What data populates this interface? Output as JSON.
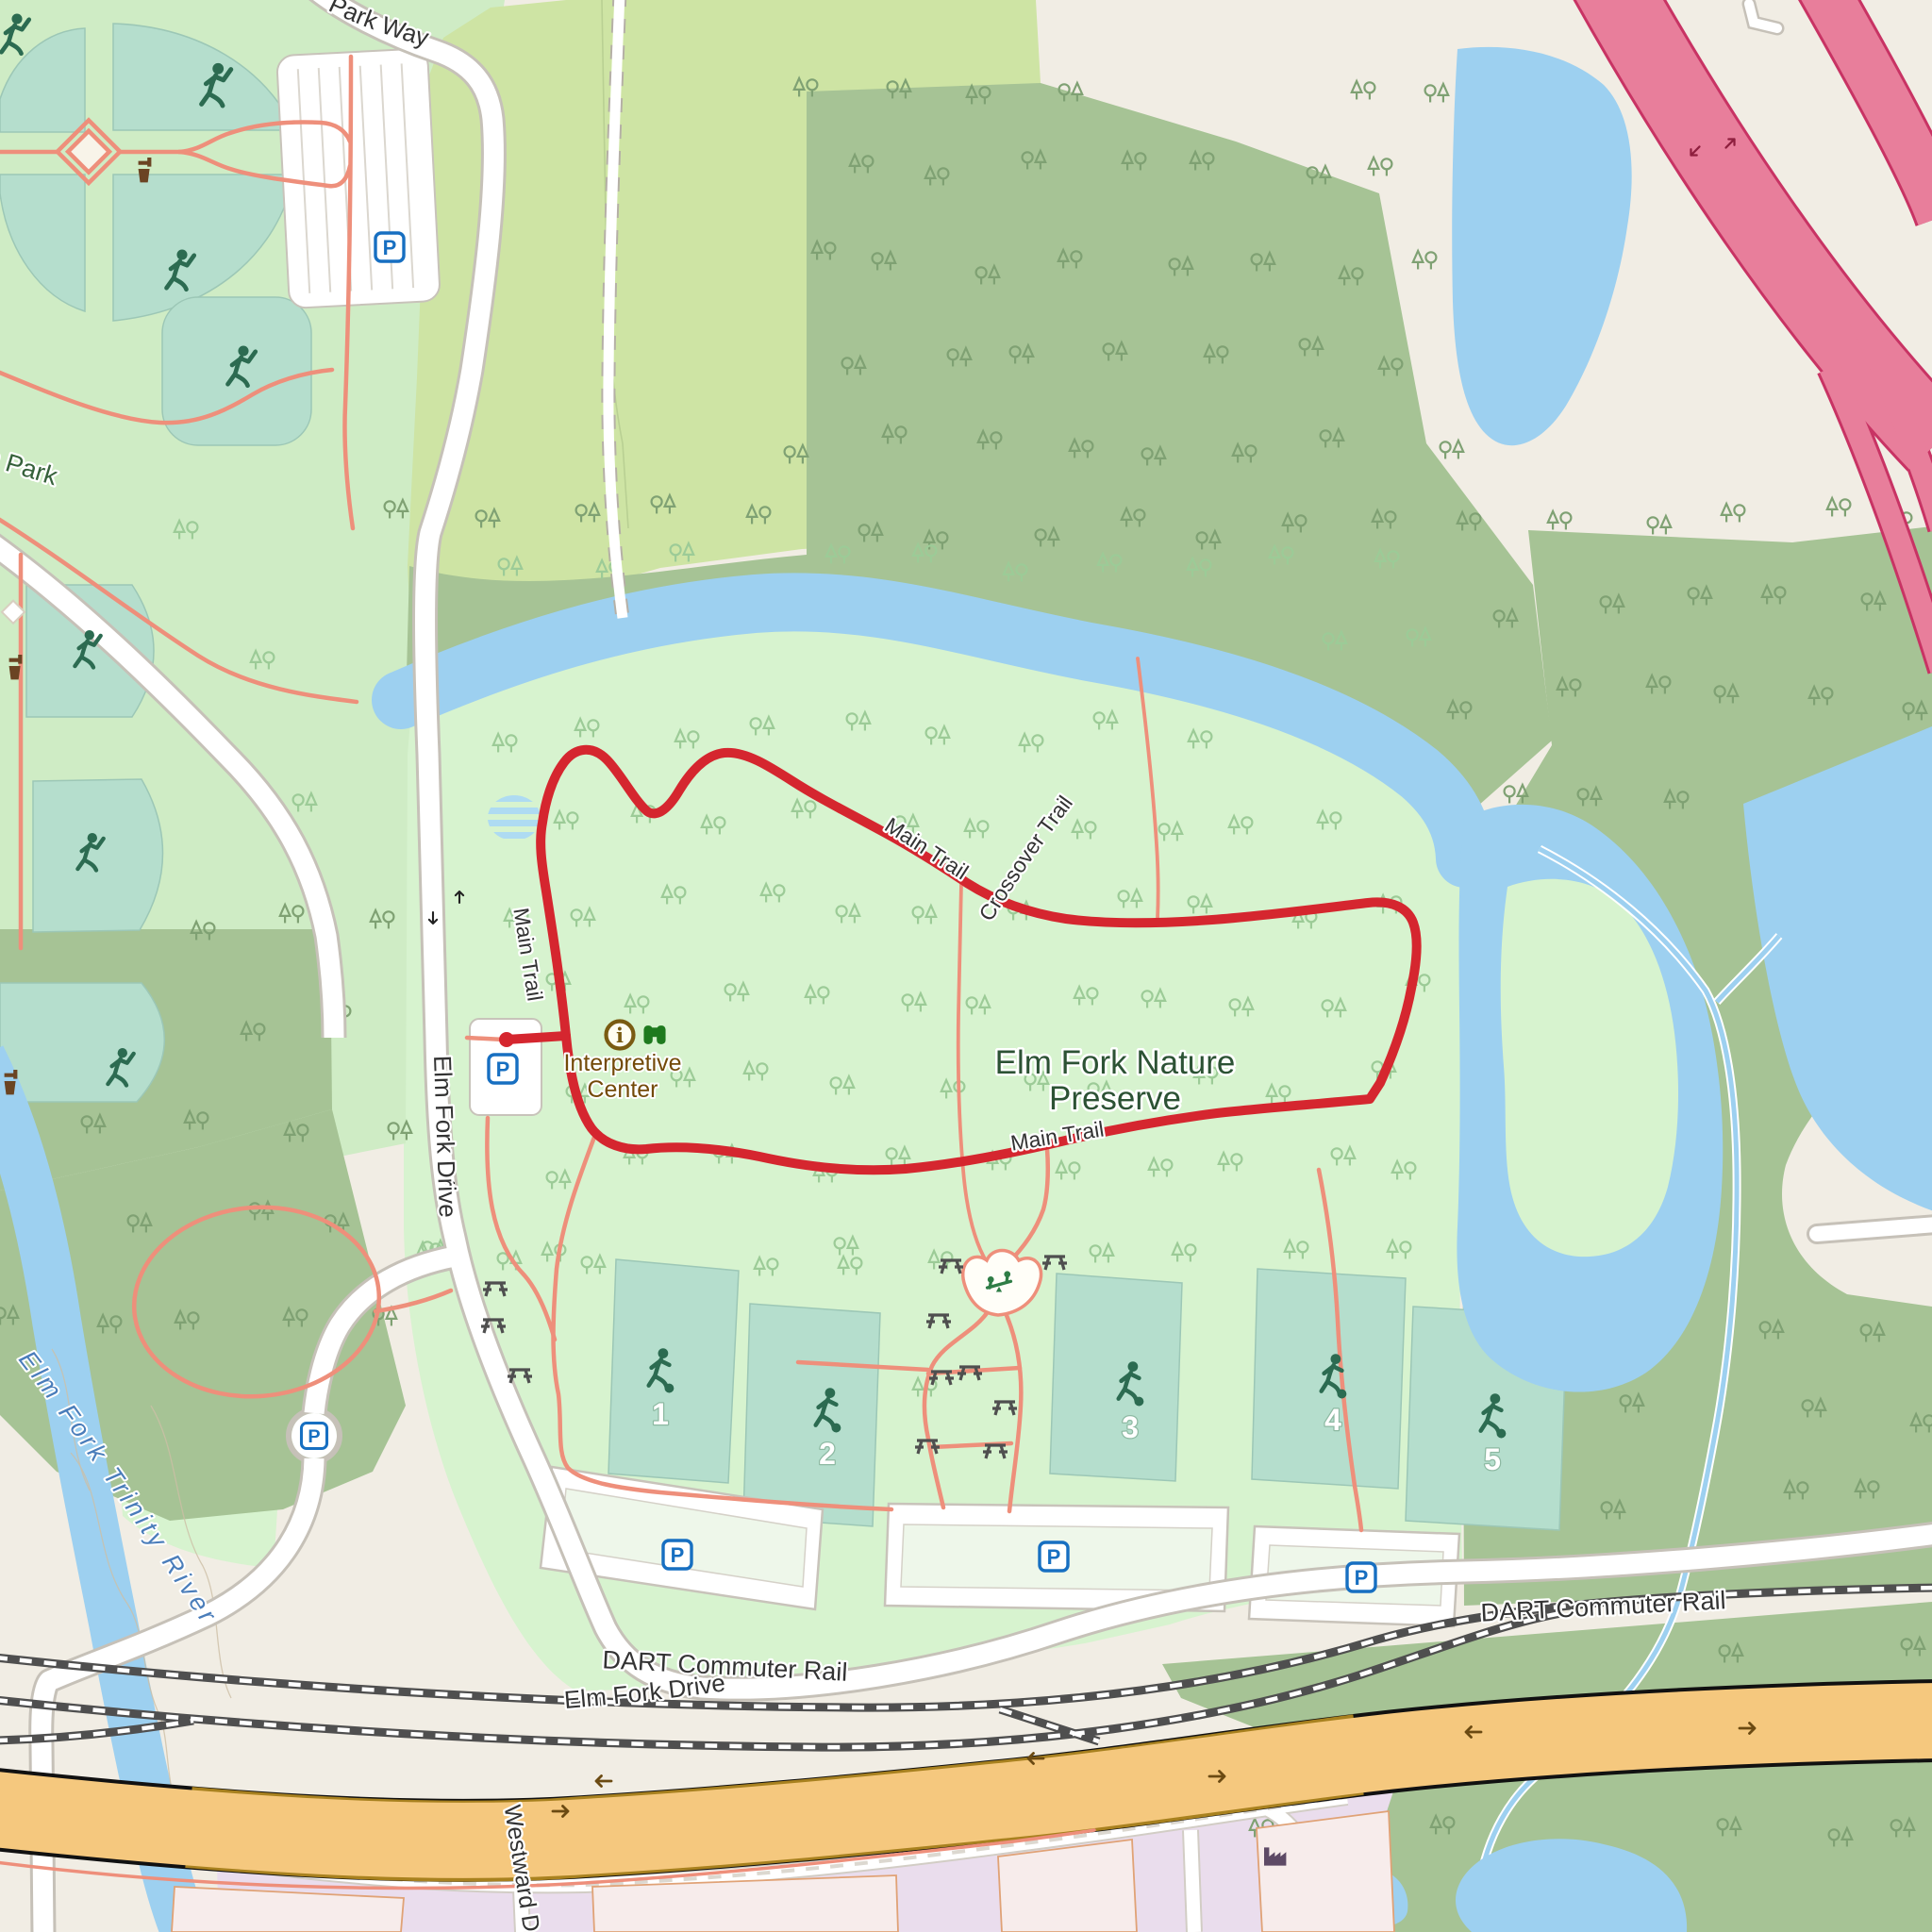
{
  "map": {
    "labels": {
      "park_way": "Park Way",
      "partial_park": "sh Park",
      "elm_fork_drive": "Elm Fork Drive",
      "elm_fork_drive_2": "Elm Fork Drive",
      "main_trail_w": "Main Trail",
      "main_trail_top": "Main Trail",
      "main_trail_s": "Main Trail",
      "crossover_trail": "Crossover Trail",
      "preserve_1": "Elm Fork Nature",
      "preserve_2": "Preserve",
      "interpretive_1": "Interpretive",
      "interpretive_2": "Center",
      "river": "Elm Fork Trinity River",
      "dart_1": "DART Commuter Rail",
      "dart_2": "DART Commuter Rail",
      "westward": "Westward D",
      "parking": "P"
    },
    "fields": [
      {
        "number": "1"
      },
      {
        "number": "2"
      },
      {
        "number": "3"
      },
      {
        "number": "4"
      },
      {
        "number": "5"
      }
    ],
    "colors": {
      "trail": "#d5262f",
      "water": "#9dd0f0",
      "forest": "#a6c395",
      "preserve": "#d7f3cf",
      "park": "#cfecc5",
      "grass": "#cee4a4",
      "pitch": "#b5decd",
      "path": "#ee8f7b",
      "motorway": "#e87e9b",
      "primary_road": "#f5c87e",
      "industrial": "#eadded"
    },
    "icons": {
      "parking": "parking-icon",
      "picnic": "picnic-table-icon",
      "drinking_water": "drinking-water-icon",
      "information": "information-icon",
      "binoculars": "viewpoint-binoculars-icon",
      "playground": "playground-seesaw-icon",
      "factory": "factory-icon",
      "baseball": "baseball-player-icon",
      "soccer": "soccer-player-icon",
      "tree": "mixed-forest-tree-icon"
    }
  }
}
